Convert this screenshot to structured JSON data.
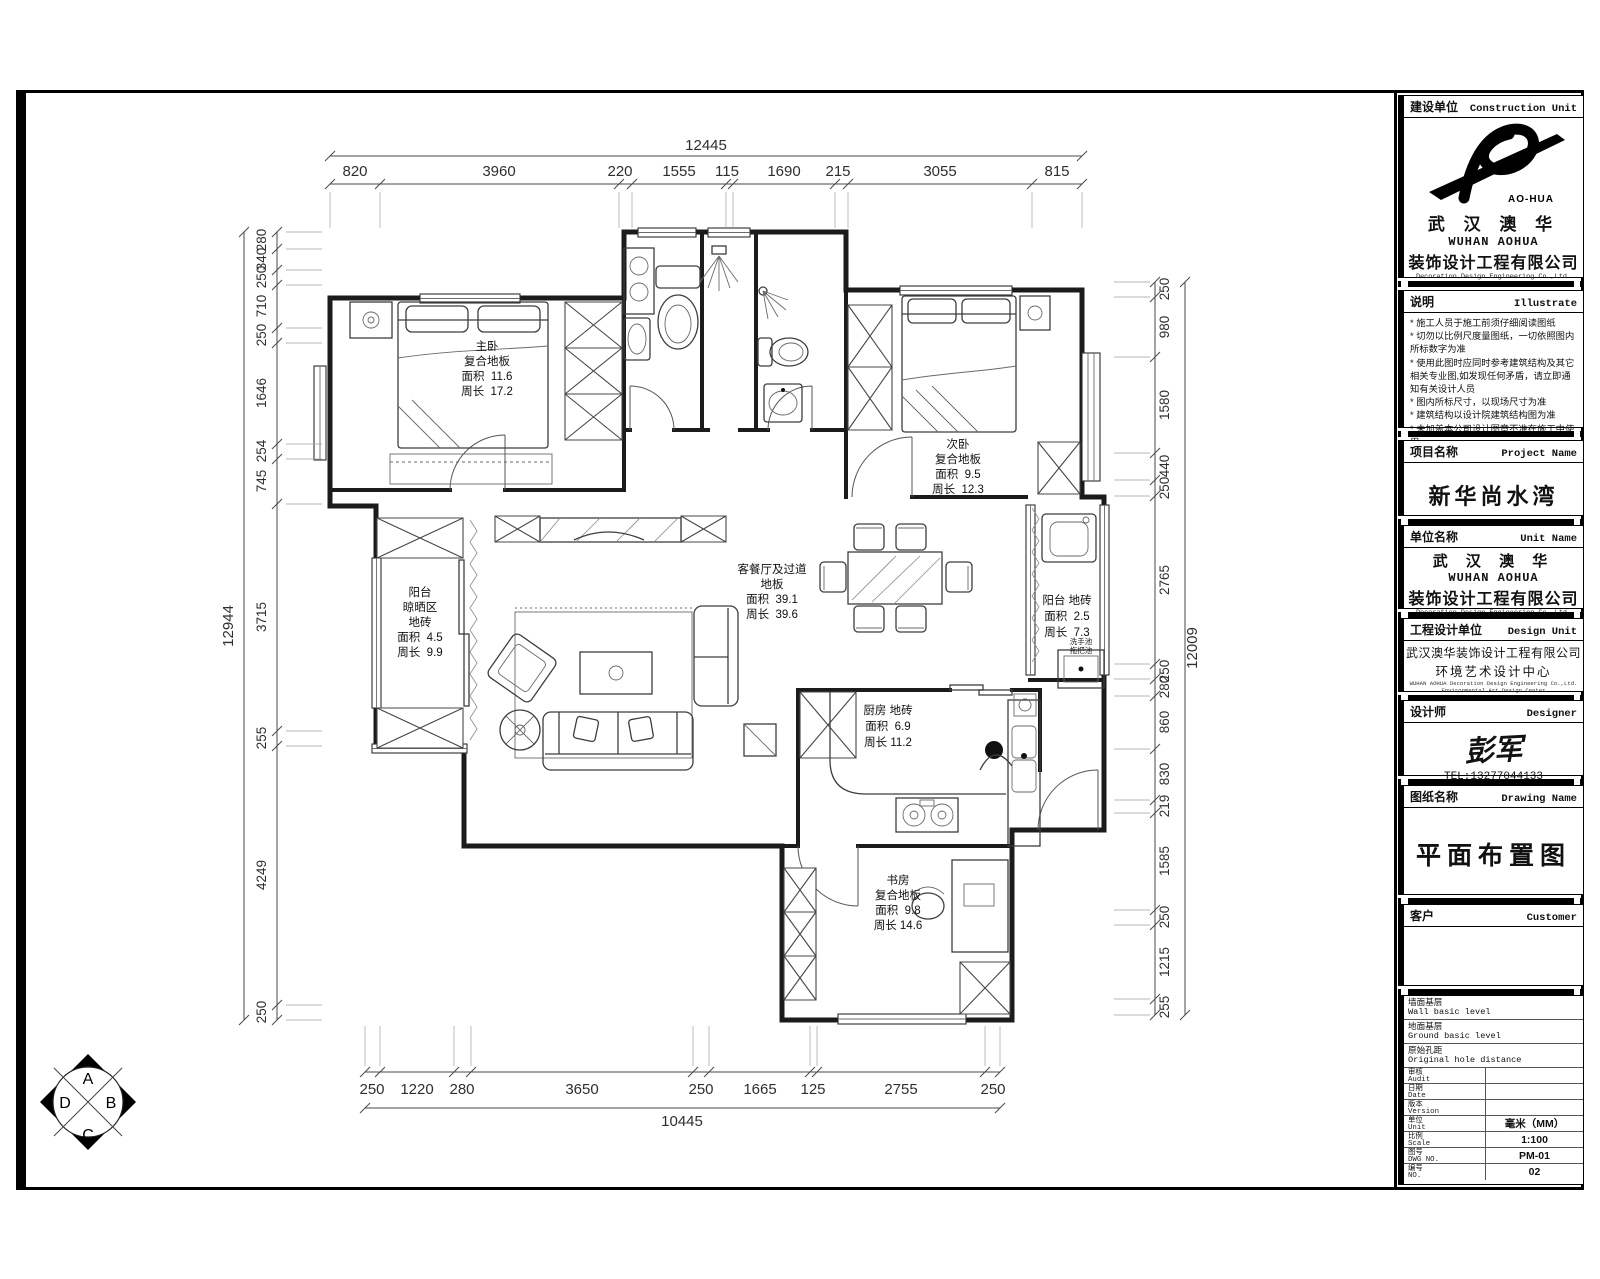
{
  "sheet": {
    "compass": {
      "top": "A",
      "right": "B",
      "bottom": "C",
      "left": "D"
    }
  },
  "title_block": {
    "construction_unit": {
      "label_cn": "建设单位",
      "label_en": "Construction Unit",
      "logo_caption": "AO-HUA",
      "brand_cn": "武 汉 澳 华",
      "brand_en": "WUHAN AOHUA",
      "company_cn": "装饰设计工程有限公司",
      "company_en": "Decoration Design Engineering Co.,Ltd."
    },
    "illustrate": {
      "label_cn": "说明",
      "label_en": "Illustrate",
      "notes": [
        "* 施工人员于施工前须仔细阅读图纸",
        "* 切勿以比例尺度量图纸，一切依照图内所标数字为准",
        "* 使用此图时应同时参考建筑结构及其它相关专业图,如发现任何矛盾，请立即通知有关设计人员",
        "* 图内所标尺寸，以现场尺寸为准",
        "* 建筑结构以设计院建筑结构图为准",
        "* 未加盖本公司设计图章不准在施工中使用"
      ]
    },
    "project": {
      "label_cn": "项目名称",
      "label_en": "Project Name",
      "value": "新华尚水湾"
    },
    "unit": {
      "label_cn": "单位名称",
      "label_en": "Unit Name",
      "brand_cn": "武 汉 澳 华",
      "brand_en": "WUHAN AOHUA",
      "company_cn": "装饰设计工程有限公司",
      "company_en": "Decoration Design Engineering Co.,Ltd."
    },
    "design_unit": {
      "label_cn": "工程设计单位",
      "label_en": "Design Unit",
      "line1": "武汉澳华装饰设计工程有限公司",
      "line2": "环境艺术设计中心",
      "line3": "WUHAN AOHUA Decoration Design Engineering Co.,Ltd.",
      "line4": "Environmental Art Design Center"
    },
    "designer": {
      "label_cn": "设计师",
      "label_en": "Designer",
      "signature": "彭军",
      "tel": "TEL:13277044133"
    },
    "drawing": {
      "label_cn": "图纸名称",
      "label_en": "Drawing Name",
      "value": "平面布置图"
    },
    "customer": {
      "label_cn": "客户",
      "label_en": "Customer",
      "value": ""
    },
    "info": {
      "wall_cn": "墙面基层",
      "wall_en": "Wall basic level",
      "ground_cn": "地面基层",
      "ground_en": "Ground basic level",
      "hole_cn": "原始孔距",
      "hole_en": "Original hole distance",
      "audit_cn": "审核",
      "audit_en": "Audit",
      "audit_val": "",
      "date_cn": "日期",
      "date_en": "Date",
      "date_val": "",
      "version_cn": "版本",
      "version_en": "Version",
      "version_val": "",
      "unit_cn": "单位",
      "unit_en": "Unit",
      "unit_val": "毫米（MM）",
      "scale_cn": "比例",
      "scale_en": "Scale",
      "scale_val": "1:100",
      "dwg_cn": "图号",
      "dwg_en": "DWG NO.",
      "dwg_val": "PM-01",
      "no_cn": "编号",
      "no_en": "NO.",
      "no_val": "02"
    }
  },
  "dimensions": {
    "top": {
      "total": "12445",
      "segments": [
        "820",
        "3960",
        "220",
        "1555",
        "115",
        "1690",
        "215",
        "3055",
        "815"
      ]
    },
    "bottom": {
      "total": "10445",
      "segments": [
        "250",
        "1220",
        "280",
        "3650",
        "250",
        "1665",
        "125",
        "2755",
        "250"
      ]
    },
    "left": {
      "total": "12944",
      "segments": [
        "280",
        "340",
        "250",
        "710",
        "250",
        "1646",
        "254",
        "745",
        "3715",
        "255",
        "4249",
        "250"
      ]
    },
    "right": {
      "total": "12009",
      "segments": [
        "250",
        "980",
        "1580",
        "440",
        "250",
        "2765",
        "250",
        "280",
        "860",
        "830",
        "219",
        "1585",
        "250",
        "1215",
        "255"
      ]
    }
  },
  "rooms": {
    "master": {
      "lines": [
        "主卧",
        "复合地板",
        "面积  11.6",
        "周长  17.2"
      ]
    },
    "second": {
      "lines": [
        "次卧",
        "复合地板",
        "面积  9.5",
        "周长  12.3"
      ]
    },
    "living": {
      "lines": [
        "客餐厅及过道",
        "地板",
        "面积  39.1",
        "周长  39.6"
      ]
    },
    "balcony_left": {
      "lines": [
        "阳台",
        "晾晒区",
        "地砖",
        "面积  4.5",
        "周长  9.9"
      ]
    },
    "balcony_right": {
      "lines": [
        "阳台 地砖",
        "面积  2.5",
        "周长  7.3"
      ]
    },
    "kitchen": {
      "lines": [
        "厨房 地砖",
        "面积  6.9",
        "周长 11.2"
      ]
    },
    "study": {
      "lines": [
        "书房",
        "复合地板",
        "面积  9.8",
        "周长 14.6"
      ]
    }
  },
  "plan_labels": {
    "hand_sink": "洗手池",
    "mop_sink": "拖把池"
  }
}
